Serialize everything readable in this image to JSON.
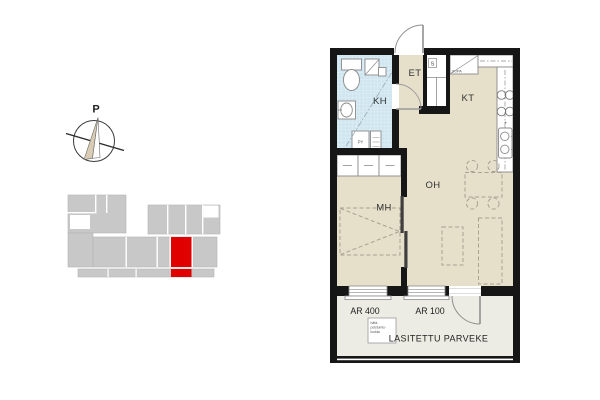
{
  "compass": {
    "north_label": "P"
  },
  "plan": {
    "room_labels": {
      "bathroom": "KH",
      "entry": "ET",
      "kitchen": "KT",
      "living": "OH",
      "bedroom": "MH"
    },
    "closet_label": "S",
    "fridge_label": "JK/PA",
    "washer_label": "PY",
    "window_left_label": "AR 400",
    "window_mid_label": "AR 100",
    "balcony_label": "LASITETTU PARVEKE",
    "hatch_label_lines": {
      "l1": "hätä-",
      "l2": "poistumis-",
      "l3": "luukku"
    }
  },
  "key_plan": {
    "highlight_color": "#e00000",
    "block_color": "#c8c8c8"
  },
  "colors": {
    "wall": "#161616",
    "floor": "#e6dfca",
    "tile": "#cfe5ef",
    "balcony_floor": "#edece4",
    "fixture_outline": "#8a8a8a",
    "furniture_dash": "#a9a293"
  }
}
